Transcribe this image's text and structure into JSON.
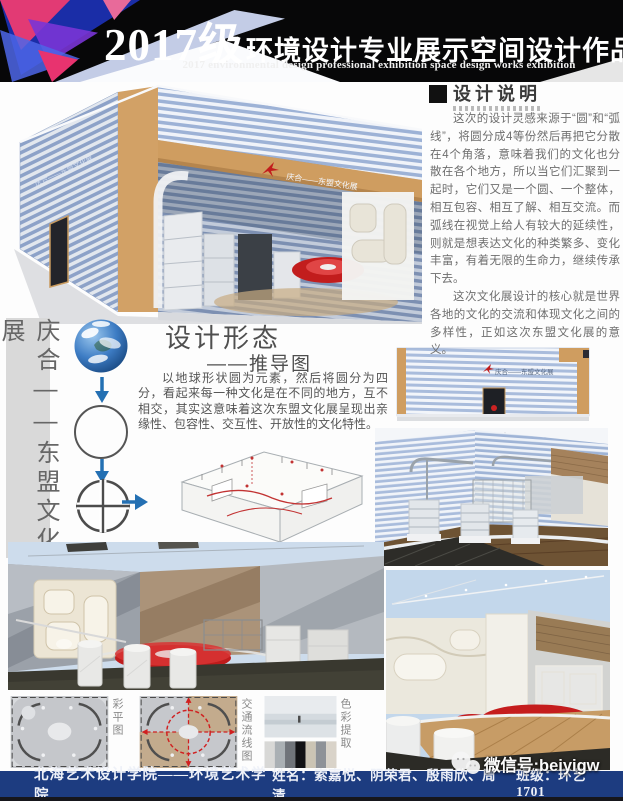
{
  "header": {
    "title_year": "2017级",
    "title_cn": "环境设计专业展示空间设计作品展",
    "subtitle_en": "2017 environmental design professional exhibition space design works exhibition"
  },
  "side_banner": {
    "text": "庆合——东盟文化展"
  },
  "building": {
    "banner_text": "庆合——东盟文化展"
  },
  "design_note": {
    "heading": "设计说明",
    "paragraph1": "这次的设计灵感来源于“圆”和“弧线”，将圆分成4等份然后再把它分散在4个角落，意味着我们的文化也分散在各个地方，所以当它们汇聚到一起时，它们又是一个圆、一个整体，相互包容、相互了解、相互交流。而弧线在视觉上给人有较大的延续性，则就是想表达文化的种类繁多、变化丰富，有着无限的生命力，继续传承下去。",
    "paragraph2": "这次文化展设计的核心就是世界各地的文化的交流和体现文化之间的多样性，正如这次东盟文化展的意义。"
  },
  "design_form": {
    "title": "设计形态",
    "subtitle": "——推导图",
    "paragraph": "以地球形状圆为元素，然后将圆分为四分，看起来每一种文化是在不同的地方，互不相交，其实这意味着这次东盟文化展呈现出亲缘性、包容性、交互性、开放性的文化特性。"
  },
  "thumbnails": [
    {
      "label": "彩平图"
    },
    {
      "label": "交通流线图"
    },
    {
      "label": "色彩提取"
    }
  ],
  "footer": {
    "school": "北海艺术设计学院——环境艺术学院",
    "names": "姓名：索嘉悦、阴荣君、殷雨欣、周清",
    "class": "班级：环艺1701"
  },
  "watermark": {
    "text": "微信号:beiyigw"
  },
  "colors": {
    "stripe_blue": "#9db2d6",
    "tan": "#cf9d60",
    "accent_red": "#c21d1d",
    "footer_navy": "#1d3c80",
    "arrow_blue": "#2470b3"
  }
}
